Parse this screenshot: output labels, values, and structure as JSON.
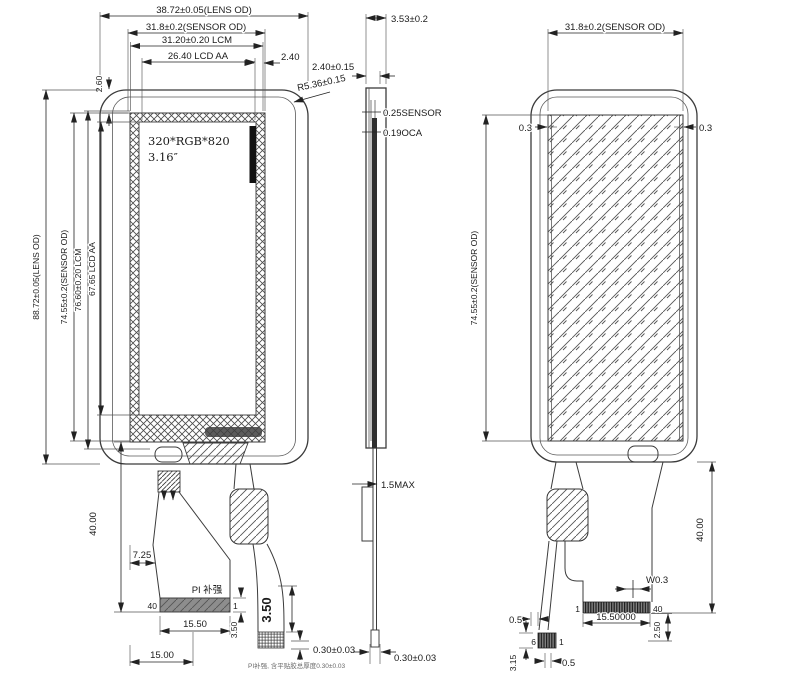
{
  "colors": {
    "ink": "#3b3b3b",
    "dark_fill": "#2f2f2f",
    "pi_bar": "#8d8d8d"
  },
  "front": {
    "w_lens": "38.72±0.05(LENS OD)",
    "w_sensor": "31.8±0.2(SENSOR OD)",
    "w_lcm": "31.20±0.20 LCM",
    "w_aa": "26.40 LCD AA",
    "gap_right": "2.40",
    "gap_top": "2.60",
    "radius": "R5.36±0.15",
    "h_lens": "88.72±0.05(LENS OD)",
    "h_sensor": "74.55±0.2(SENSOR OD)",
    "h_lcm": "76.60±0.20 LCM",
    "h_aa": "67.65 LCD AA",
    "screen_line1": "320*RGB*820",
    "screen_line2": "3.16″",
    "tail_len": "40.00",
    "tail_offset": "7.25",
    "pi_label": "PI 补强",
    "pin_left": "40",
    "pin_right": "1",
    "pi_width": "15.50",
    "pi_offset": "15.00",
    "pi_thick": "3.50",
    "tail_thick": "3.50",
    "adhesive": "0.30±0.03",
    "note": "PI补强, 含平贴胶总厚度0.30±0.03"
  },
  "side": {
    "total": "3.53±0.2",
    "lens": "2.40±0.15",
    "sensor": "0.25SENSOR",
    "oca": "0.19OCA",
    "fpc_max": "1.5MAX",
    "fpc": "0.30±0.03"
  },
  "back": {
    "w_sensor": "31.8±0.2(SENSOR OD)",
    "margin_l": "0.3",
    "margin_r": "0.3",
    "h_sensor": "74.55±0.2(SENSOR OD)",
    "tail_len": "40.00",
    "trace": "W0.3",
    "pin_first": "1",
    "pin_last": "40",
    "conn_width": "15.50000",
    "conn_offset": "2.50",
    "gap_a": "0.5",
    "pin_small_first": "6",
    "pin_small_last": "1",
    "small_h": "3.15",
    "gap_b": "0.5"
  }
}
